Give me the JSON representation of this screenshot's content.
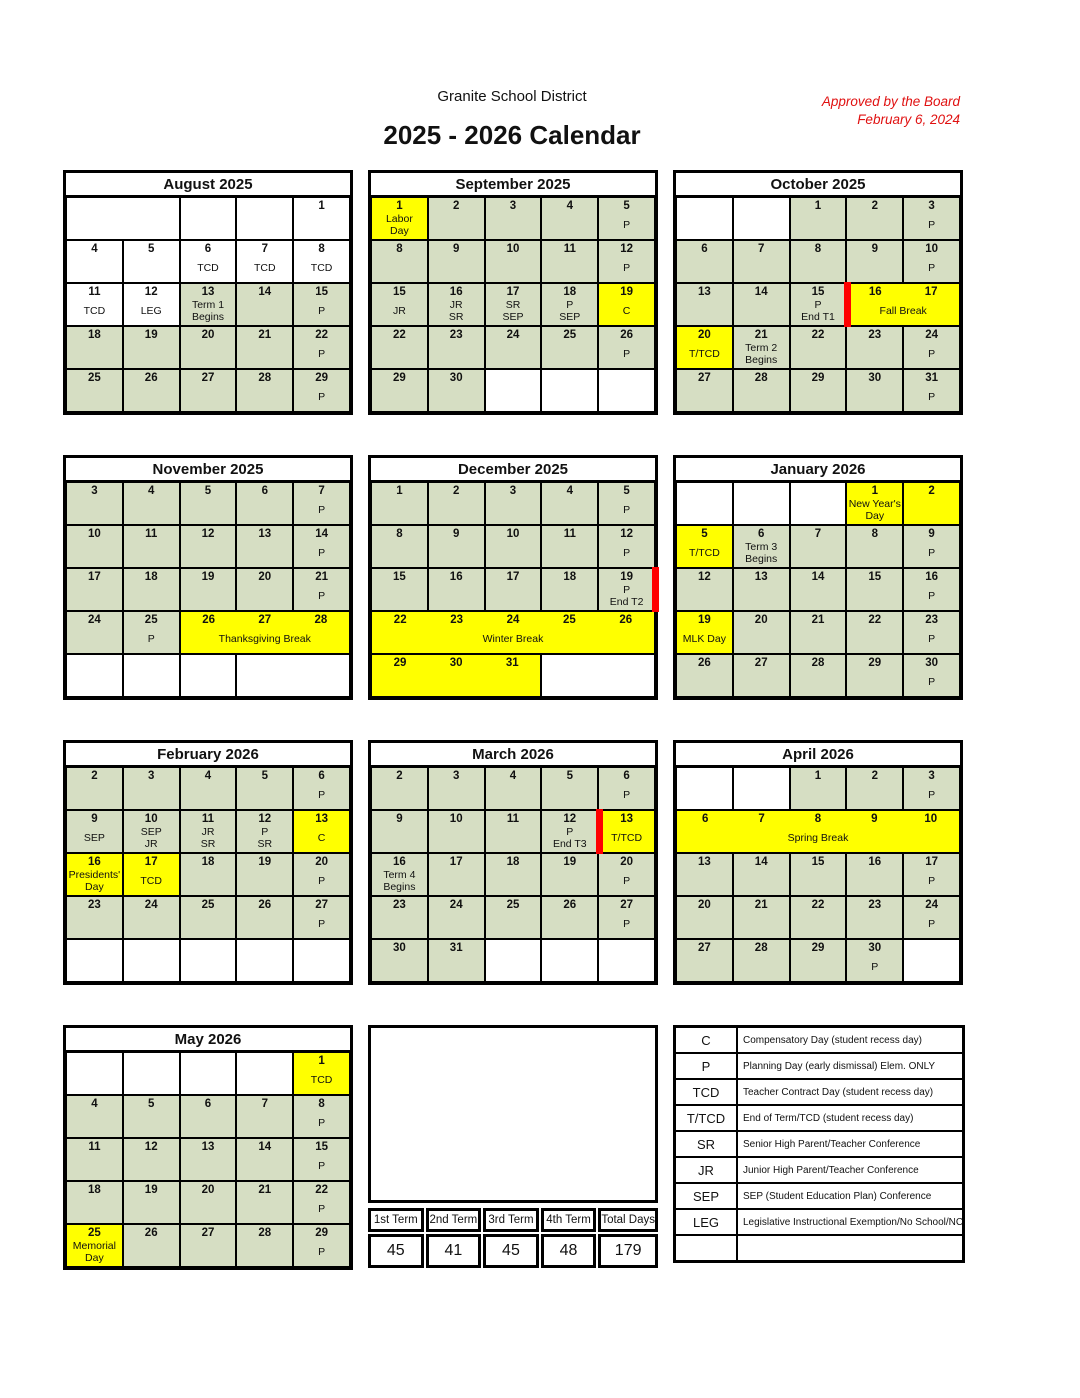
{
  "colors": {
    "cell_green": "#d6dec3",
    "highlight_yellow": "#ffff00",
    "term_end_red": "#ff0000",
    "approved_red": "#e01010"
  },
  "header": {
    "org": "Granite School District",
    "title": "2025 - 2026 Calendar",
    "approved": "Approved by the Board\nFebruary 6, 2024"
  },
  "months": [
    {
      "title": "August 2025",
      "rows": [
        [
          {
            "span": 2,
            "bg": "white"
          },
          {
            "bg": "white"
          },
          {
            "bg": "white"
          },
          {
            "day": "1",
            "bg": "white"
          }
        ],
        [
          {
            "day": "4",
            "bg": "white"
          },
          {
            "day": "5",
            "bg": "white"
          },
          {
            "day": "6",
            "text": "TCD",
            "bg": "white"
          },
          {
            "day": "7",
            "text": "TCD",
            "bg": "white"
          },
          {
            "day": "8",
            "text": "TCD",
            "bg": "white"
          }
        ],
        [
          {
            "day": "11",
            "text": "TCD",
            "bg": "white"
          },
          {
            "day": "12",
            "text": "LEG",
            "bg": "white"
          },
          {
            "day": "13",
            "text": "Term 1\nBegins"
          },
          {
            "day": "14"
          },
          {
            "day": "15",
            "text": "P"
          }
        ],
        [
          {
            "day": "18"
          },
          {
            "day": "19"
          },
          {
            "day": "20"
          },
          {
            "day": "21"
          },
          {
            "day": "22",
            "text": "P"
          }
        ],
        [
          {
            "day": "25"
          },
          {
            "day": "26"
          },
          {
            "day": "27"
          },
          {
            "day": "28"
          },
          {
            "day": "29",
            "text": "P"
          }
        ]
      ]
    },
    {
      "title": "September 2025",
      "rows": [
        [
          {
            "day": "1",
            "text": "Labor\nDay",
            "bg": "yellow"
          },
          {
            "day": "2"
          },
          {
            "day": "3"
          },
          {
            "day": "4"
          },
          {
            "day": "5",
            "text": "P"
          }
        ],
        [
          {
            "day": "8"
          },
          {
            "day": "9"
          },
          {
            "day": "10"
          },
          {
            "day": "11"
          },
          {
            "day": "12",
            "text": "P"
          }
        ],
        [
          {
            "day": "15",
            "text": "JR"
          },
          {
            "day": "16",
            "text": "JR\nSR"
          },
          {
            "day": "17",
            "text": "SR\nSEP"
          },
          {
            "day": "18",
            "text": "P\nSEP"
          },
          {
            "day": "19",
            "text": "C",
            "bg": "yellow"
          }
        ],
        [
          {
            "day": "22"
          },
          {
            "day": "23"
          },
          {
            "day": "24"
          },
          {
            "day": "25"
          },
          {
            "day": "26",
            "text": "P"
          }
        ],
        [
          {
            "day": "29"
          },
          {
            "day": "30"
          },
          {
            "bg": "white"
          },
          {
            "bg": "white"
          },
          {
            "bg": "white"
          }
        ]
      ]
    },
    {
      "title": "October 2025",
      "rows": [
        [
          {
            "bg": "white"
          },
          {
            "bg": "white"
          },
          {
            "day": "1"
          },
          {
            "day": "2"
          },
          {
            "day": "3",
            "text": "P"
          }
        ],
        [
          {
            "day": "6"
          },
          {
            "day": "7"
          },
          {
            "day": "8"
          },
          {
            "day": "9"
          },
          {
            "day": "10",
            "text": "P"
          }
        ],
        [
          {
            "day": "13"
          },
          {
            "day": "14"
          },
          {
            "day": "15",
            "text": "P\nEnd T1"
          },
          {
            "days": [
              "16",
              "17"
            ],
            "span": 2,
            "text": "Fall Break",
            "bg": "yellow",
            "redbar": "left"
          }
        ],
        [
          {
            "day": "20",
            "text": "T/TCD",
            "bg": "yellow"
          },
          {
            "day": "21",
            "text": "Term 2\nBegins"
          },
          {
            "day": "22"
          },
          {
            "day": "23"
          },
          {
            "day": "24",
            "text": "P"
          }
        ],
        [
          {
            "day": "27"
          },
          {
            "day": "28"
          },
          {
            "day": "29"
          },
          {
            "day": "30"
          },
          {
            "day": "31",
            "text": "P"
          }
        ]
      ]
    },
    {
      "title": "November 2025",
      "rows": [
        [
          {
            "day": "3"
          },
          {
            "day": "4"
          },
          {
            "day": "5"
          },
          {
            "day": "6"
          },
          {
            "day": "7",
            "text": "P"
          }
        ],
        [
          {
            "day": "10"
          },
          {
            "day": "11"
          },
          {
            "day": "12"
          },
          {
            "day": "13"
          },
          {
            "day": "14",
            "text": "P"
          }
        ],
        [
          {
            "day": "17"
          },
          {
            "day": "18"
          },
          {
            "day": "19"
          },
          {
            "day": "20"
          },
          {
            "day": "21",
            "text": "P"
          }
        ],
        [
          {
            "day": "24"
          },
          {
            "day": "25",
            "text": "P"
          },
          {
            "days": [
              "26",
              "27",
              "28"
            ],
            "span": 3,
            "text": "Thanksgiving Break",
            "bg": "yellow"
          }
        ],
        [
          {
            "bg": "white"
          },
          {
            "bg": "white"
          },
          {
            "bg": "white"
          },
          {
            "span": 2,
            "bg": "white"
          }
        ]
      ]
    },
    {
      "title": "December 2025",
      "rows": [
        [
          {
            "day": "1"
          },
          {
            "day": "2"
          },
          {
            "day": "3"
          },
          {
            "day": "4"
          },
          {
            "day": "5",
            "text": "P"
          }
        ],
        [
          {
            "day": "8"
          },
          {
            "day": "9"
          },
          {
            "day": "10"
          },
          {
            "day": "11"
          },
          {
            "day": "12",
            "text": "P"
          }
        ],
        [
          {
            "day": "15"
          },
          {
            "day": "16"
          },
          {
            "day": "17"
          },
          {
            "day": "18"
          },
          {
            "day": "19",
            "text": "P\nEnd T2",
            "redbar": "right"
          }
        ],
        [
          {
            "days": [
              "22",
              "23",
              "24",
              "25",
              "26"
            ],
            "span": 5,
            "text": "Winter Break",
            "bg": "yellow"
          }
        ],
        [
          {
            "days": [
              "29",
              "30",
              "31"
            ],
            "span": 3,
            "bg": "yellow"
          },
          {
            "span": 2,
            "bg": "white"
          }
        ]
      ]
    },
    {
      "title": "January 2026",
      "rows": [
        [
          {
            "bg": "white"
          },
          {
            "bg": "white"
          },
          {
            "bg": "white"
          },
          {
            "day": "1",
            "text": "New Year's\nDay",
            "bg": "yellow"
          },
          {
            "day": "2",
            "bg": "yellow"
          }
        ],
        [
          {
            "day": "5",
            "text": "T/TCD",
            "bg": "yellow"
          },
          {
            "day": "6",
            "text": "Term 3\nBegins"
          },
          {
            "day": "7"
          },
          {
            "day": "8"
          },
          {
            "day": "9",
            "text": "P"
          }
        ],
        [
          {
            "day": "12"
          },
          {
            "day": "13"
          },
          {
            "day": "14"
          },
          {
            "day": "15"
          },
          {
            "day": "16",
            "text": "P"
          }
        ],
        [
          {
            "day": "19",
            "text": "MLK Day",
            "bg": "yellow"
          },
          {
            "day": "20"
          },
          {
            "day": "21"
          },
          {
            "day": "22"
          },
          {
            "day": "23",
            "text": "P"
          }
        ],
        [
          {
            "day": "26"
          },
          {
            "day": "27"
          },
          {
            "day": "28"
          },
          {
            "day": "29"
          },
          {
            "day": "30",
            "text": "P"
          }
        ]
      ]
    },
    {
      "title": "February 2026",
      "rows": [
        [
          {
            "day": "2"
          },
          {
            "day": "3"
          },
          {
            "day": "4"
          },
          {
            "day": "5"
          },
          {
            "day": "6",
            "text": "P"
          }
        ],
        [
          {
            "day": "9",
            "text": "SEP"
          },
          {
            "day": "10",
            "text": "SEP\nJR"
          },
          {
            "day": "11",
            "text": "JR\nSR"
          },
          {
            "day": "12",
            "text": "P\nSR"
          },
          {
            "day": "13",
            "text": "C",
            "bg": "yellow"
          }
        ],
        [
          {
            "day": "16",
            "text": "Presidents'\nDay",
            "bg": "yellow"
          },
          {
            "day": "17",
            "text": "TCD",
            "bg": "yellow"
          },
          {
            "day": "18"
          },
          {
            "day": "19"
          },
          {
            "day": "20",
            "text": "P"
          }
        ],
        [
          {
            "day": "23"
          },
          {
            "day": "24"
          },
          {
            "day": "25"
          },
          {
            "day": "26"
          },
          {
            "day": "27",
            "text": "P"
          }
        ],
        [
          {
            "bg": "white"
          },
          {
            "bg": "white"
          },
          {
            "bg": "white"
          },
          {
            "bg": "white"
          },
          {
            "bg": "white"
          }
        ]
      ]
    },
    {
      "title": "March 2026",
      "rows": [
        [
          {
            "day": "2"
          },
          {
            "day": "3"
          },
          {
            "day": "4"
          },
          {
            "day": "5"
          },
          {
            "day": "6",
            "text": "P"
          }
        ],
        [
          {
            "day": "9"
          },
          {
            "day": "10"
          },
          {
            "day": "11"
          },
          {
            "day": "12",
            "text": "P\nEnd T3"
          },
          {
            "day": "13",
            "text": "T/TCD",
            "bg": "yellow",
            "redbar": "left"
          }
        ],
        [
          {
            "day": "16",
            "text": "Term 4\nBegins"
          },
          {
            "day": "17"
          },
          {
            "day": "18"
          },
          {
            "day": "19"
          },
          {
            "day": "20",
            "text": "P"
          }
        ],
        [
          {
            "day": "23"
          },
          {
            "day": "24"
          },
          {
            "day": "25"
          },
          {
            "day": "26"
          },
          {
            "day": "27",
            "text": "P"
          }
        ],
        [
          {
            "day": "30"
          },
          {
            "day": "31"
          },
          {
            "bg": "white"
          },
          {
            "bg": "white"
          },
          {
            "bg": "white"
          }
        ]
      ]
    },
    {
      "title": "April 2026",
      "rows": [
        [
          {
            "bg": "white"
          },
          {
            "bg": "white"
          },
          {
            "day": "1"
          },
          {
            "day": "2"
          },
          {
            "day": "3",
            "text": "P"
          }
        ],
        [
          {
            "days": [
              "6",
              "7",
              "8",
              "9",
              "10"
            ],
            "span": 5,
            "text": "Spring Break",
            "bg": "yellow"
          }
        ],
        [
          {
            "day": "13"
          },
          {
            "day": "14"
          },
          {
            "day": "15"
          },
          {
            "day": "16"
          },
          {
            "day": "17",
            "text": "P"
          }
        ],
        [
          {
            "day": "20"
          },
          {
            "day": "21"
          },
          {
            "day": "22"
          },
          {
            "day": "23"
          },
          {
            "day": "24",
            "text": "P"
          }
        ],
        [
          {
            "day": "27"
          },
          {
            "day": "28"
          },
          {
            "day": "29"
          },
          {
            "day": "30",
            "text": "P"
          },
          {
            "bg": "white"
          }
        ]
      ]
    },
    {
      "title": "May 2026",
      "rows": [
        [
          {
            "bg": "white"
          },
          {
            "bg": "white"
          },
          {
            "bg": "white"
          },
          {
            "bg": "white"
          },
          {
            "day": "1",
            "text": "TCD",
            "bg": "yellow"
          }
        ],
        [
          {
            "day": "4"
          },
          {
            "day": "5"
          },
          {
            "day": "6"
          },
          {
            "day": "7"
          },
          {
            "day": "8",
            "text": "P"
          }
        ],
        [
          {
            "day": "11"
          },
          {
            "day": "12"
          },
          {
            "day": "13"
          },
          {
            "day": "14"
          },
          {
            "day": "15",
            "text": "P"
          }
        ],
        [
          {
            "day": "18"
          },
          {
            "day": "19"
          },
          {
            "day": "20"
          },
          {
            "day": "21"
          },
          {
            "day": "22",
            "text": "P"
          }
        ],
        [
          {
            "day": "25",
            "text": "Memorial\nDay",
            "bg": "yellow"
          },
          {
            "day": "26"
          },
          {
            "day": "27"
          },
          {
            "day": "28"
          },
          {
            "day": "29",
            "text": "P"
          }
        ]
      ]
    }
  ],
  "legend": {
    "rows": [
      {
        "symbol": "C",
        "description": "Compensatory Day (student recess day)"
      },
      {
        "symbol": "P",
        "description": "Planning Day (early dismissal)  Elem. ONLY"
      },
      {
        "symbol": "TCD",
        "description": "Teacher Contract Day (student recess day)"
      },
      {
        "symbol": "T/TCD",
        "description": "End of Term/TCD (student recess day)"
      },
      {
        "symbol": "SR",
        "description": "Senior High Parent/Teacher Conference"
      },
      {
        "symbol": "JR",
        "description": "Junior High Parent/Teacher Conference"
      },
      {
        "symbol": "SEP",
        "description": "SEP (Student Education Plan) Conference"
      },
      {
        "symbol": "LEG",
        "description": "Legislative Instructional Exemption/No School/NC"
      },
      {
        "symbol": "",
        "description": ""
      }
    ]
  },
  "terms": {
    "headers": [
      "1st Term",
      "2nd Term",
      "3rd Term",
      "4th Term",
      "Total Days"
    ],
    "values": [
      "45",
      "41",
      "45",
      "48",
      "179"
    ]
  }
}
